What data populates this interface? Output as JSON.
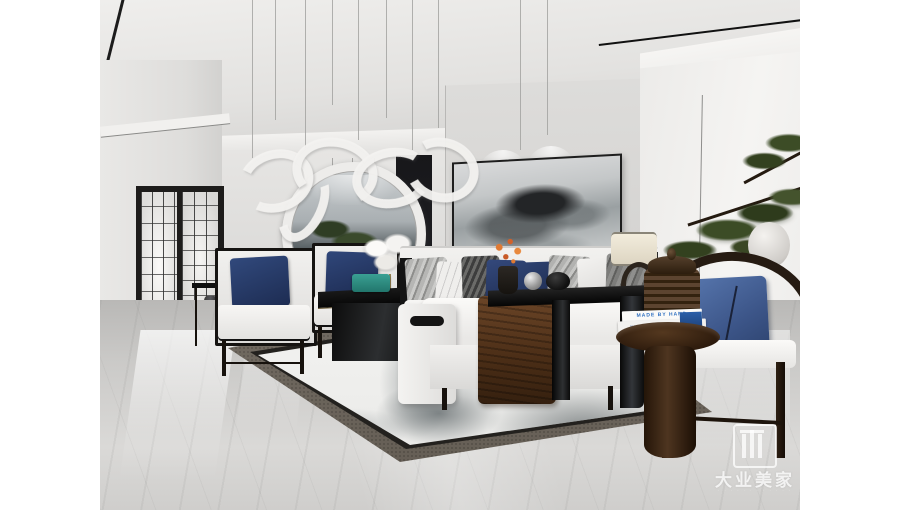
{
  "scene": {
    "type": "interior-3d-render",
    "description": "Modern new-Chinese style living room: white sofas with navy pillows, black coffee tables, moon mirror, ink-wash painting and rug, pine bonsai, gray marble floor",
    "letterbox": "white vertical bars left and right of the photograph"
  },
  "watermark": {
    "brand": "大业美家",
    "tagline": "· · · · · · · · · · · ·",
    "logo_icon": "daye-gate-logo-icon"
  },
  "decor_text": {
    "book_top_spine": "MADE BY HAND",
    "book_bottom_spine": "NURSING HOME AND BACK"
  },
  "palette": {
    "letterbox": "#ffffff",
    "wall_gray": "#e2e1df",
    "ceiling_gray": "#dcdcda",
    "accent_navy": "#2d3f68",
    "accent_blue": "#4a679e",
    "wood_dark": "#2a1d13",
    "throw_brown": "#53341e",
    "rug_border": "#6b645b",
    "floor_gray": "#c9c8c6",
    "pine_green": "#3a4727",
    "teal_box": "#2f8f85"
  }
}
